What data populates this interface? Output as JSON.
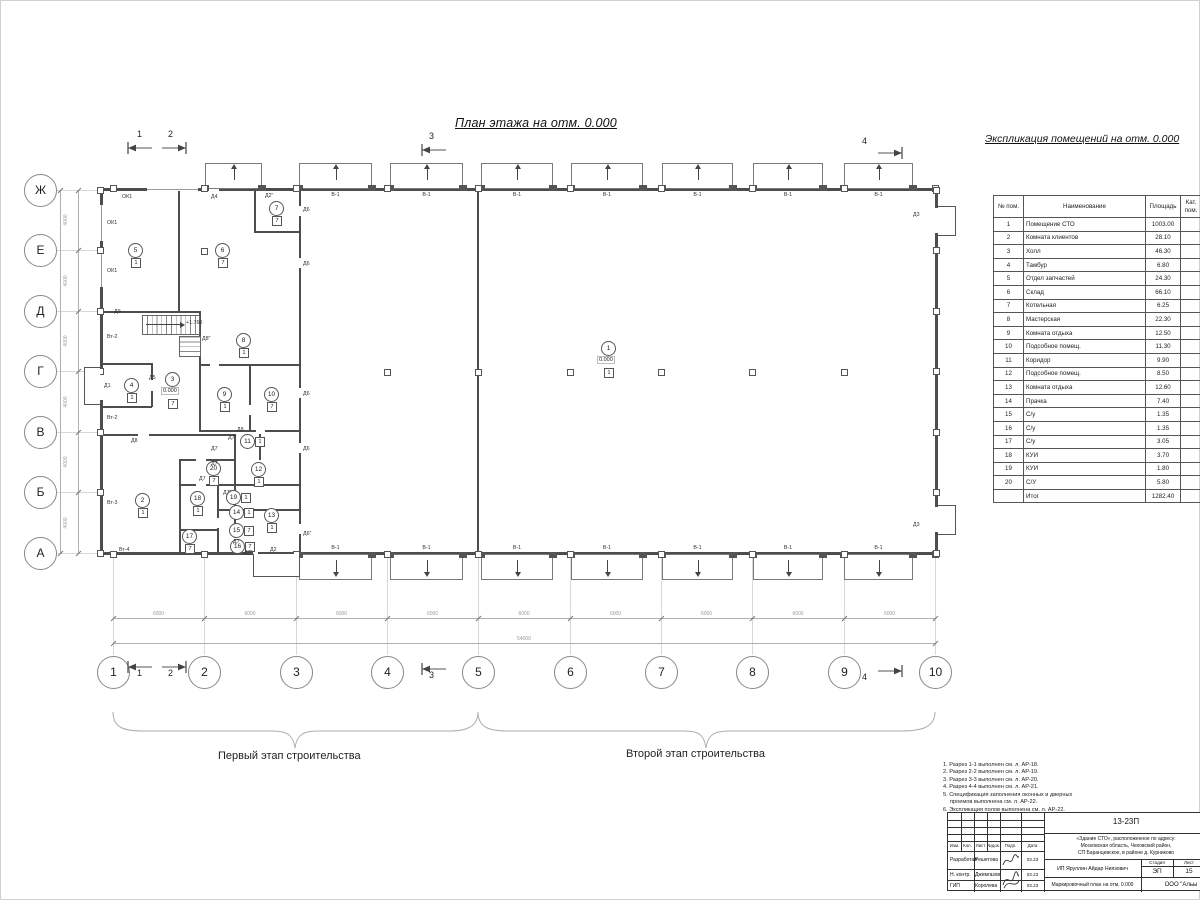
{
  "plan": {
    "title": "План этажа на отм. 0.000",
    "stage1_label": "Первый этап строительства",
    "stage2_label": "Второй этап строительства",
    "gate_label": "В-1",
    "axes_letters": [
      "Ж",
      "Е",
      "Д",
      "Г",
      "В",
      "Б",
      "А"
    ],
    "axes_numbers": [
      "1",
      "2",
      "3",
      "4",
      "5",
      "6",
      "7",
      "8",
      "9",
      "10"
    ],
    "section_markers": [
      "1",
      "2",
      "3",
      "4"
    ],
    "dims": {
      "bottom": {
        "spans": [
          "6000",
          "6000",
          "6000",
          "6000",
          "6000",
          "6000",
          "6000",
          "6000",
          "6000"
        ],
        "total": "54000"
      },
      "left": {
        "spans": [
          "4000",
          "4000",
          "4000",
          "4000",
          "4000",
          "4000"
        ],
        "total": "24000"
      }
    },
    "rooms": [
      {
        "n": "1",
        "cat": "1",
        "lvl": "0.000",
        "x": 608,
        "y": 348
      },
      {
        "n": "2",
        "cat": "1",
        "x": 142,
        "y": 500
      },
      {
        "n": "3",
        "cat": "7",
        "lvl": "0.000",
        "x": 172,
        "y": 379
      },
      {
        "n": "4",
        "cat": "1",
        "x": 131,
        "y": 385
      },
      {
        "n": "5",
        "cat": "1",
        "x": 135,
        "y": 250
      },
      {
        "n": "6",
        "cat": "7",
        "x": 222,
        "y": 250
      },
      {
        "n": "7",
        "cat": "7",
        "x": 276,
        "y": 208
      },
      {
        "n": "8",
        "cat": "1",
        "x": 243,
        "y": 340
      },
      {
        "n": "9",
        "cat": "1",
        "x": 224,
        "y": 394
      },
      {
        "n": "10",
        "cat": "7",
        "x": 271,
        "y": 394
      },
      {
        "n": "11",
        "cat": "1",
        "x": 247,
        "y": 441
      },
      {
        "n": "12",
        "cat": "1",
        "x": 258,
        "y": 469
      },
      {
        "n": "13",
        "cat": "1",
        "x": 271,
        "y": 515
      },
      {
        "n": "14",
        "cat": "1",
        "x": 236,
        "y": 512
      },
      {
        "n": "15",
        "cat": "7",
        "x": 236,
        "y": 530
      },
      {
        "n": "16",
        "cat": "7",
        "x": 237,
        "y": 546
      },
      {
        "n": "17",
        "cat": "7",
        "x": 189,
        "y": 536
      },
      {
        "n": "18",
        "cat": "1",
        "x": 197,
        "y": 498
      },
      {
        "n": "19",
        "cat": "1",
        "x": 233,
        "y": 497
      },
      {
        "n": "20",
        "cat": "7",
        "x": 213,
        "y": 468
      }
    ],
    "labels": [
      {
        "t": "ОК1",
        "x": 122,
        "y": 194
      },
      {
        "t": "ОК1",
        "x": 107,
        "y": 220
      },
      {
        "t": "ОК1",
        "x": 107,
        "y": 268
      },
      {
        "t": "Д4",
        "x": 211,
        "y": 194
      },
      {
        "t": "Д2\"",
        "x": 265,
        "y": 193
      },
      {
        "t": "Д6",
        "x": 303,
        "y": 207
      },
      {
        "t": "Д6",
        "x": 303,
        "y": 261
      },
      {
        "t": "Д6",
        "x": 303,
        "y": 391
      },
      {
        "t": "Д6",
        "x": 303,
        "y": 446
      },
      {
        "t": "Д6\"",
        "x": 303,
        "y": 531
      },
      {
        "t": "Д9",
        "x": 114,
        "y": 309
      },
      {
        "t": "Вт-2",
        "x": 107,
        "y": 334
      },
      {
        "t": "Вт-2",
        "x": 107,
        "y": 415
      },
      {
        "t": "Вт-3",
        "x": 107,
        "y": 500
      },
      {
        "t": "Вт-4",
        "x": 119,
        "y": 547
      },
      {
        "t": "Д1",
        "x": 104,
        "y": 383
      },
      {
        "t": "Д5",
        "x": 149,
        "y": 375
      },
      {
        "t": "Д8",
        "x": 131,
        "y": 438
      },
      {
        "t": "Д8",
        "x": 237,
        "y": 427
      },
      {
        "t": "Д8\"",
        "x": 202,
        "y": 336
      },
      {
        "t": "Д7\"",
        "x": 228,
        "y": 435
      },
      {
        "t": "Д7",
        "x": 211,
        "y": 446
      },
      {
        "t": "Д7",
        "x": 211,
        "y": 461
      },
      {
        "t": "Д7",
        "x": 199,
        "y": 476
      },
      {
        "t": "Д7\"",
        "x": 223,
        "y": 490
      },
      {
        "t": "Д7",
        "x": 233,
        "y": 539
      },
      {
        "t": "Д7\"",
        "x": 244,
        "y": 550
      },
      {
        "t": "Д2",
        "x": 270,
        "y": 547
      },
      {
        "t": "Д3",
        "x": 913,
        "y": 212
      },
      {
        "t": "Д3",
        "x": 913,
        "y": 522
      },
      {
        "t": "+1.760",
        "x": 186,
        "y": 320
      }
    ]
  },
  "schedule": {
    "title": "Экспликация помещений на отм. 0.000",
    "columns": [
      "№ пом.",
      "Наименование",
      "Площадь",
      "Кат. пом."
    ],
    "rows": [
      [
        "1",
        "Помещение СТО",
        "1003.00"
      ],
      [
        "2",
        "Комната клиентов",
        "28.10"
      ],
      [
        "3",
        "Холл",
        "46.30"
      ],
      [
        "4",
        "Тамбур",
        "6.80"
      ],
      [
        "5",
        "Отдел запчастей",
        "24.30"
      ],
      [
        "6",
        "Склад",
        "66.10"
      ],
      [
        "7",
        "Котельная",
        "6.25"
      ],
      [
        "8",
        "Мастерская",
        "22.30"
      ],
      [
        "9",
        "Комната отдыха",
        "12.50"
      ],
      [
        "10",
        "Подсобное помещ.",
        "11.30"
      ],
      [
        "11",
        "Коридор",
        "9.90"
      ],
      [
        "12",
        "Подсобное помещ.",
        "8.50"
      ],
      [
        "13",
        "Комната отдыха",
        "12.60"
      ],
      [
        "14",
        "Прачка",
        "7.40"
      ],
      [
        "15",
        "С/у",
        "1.35"
      ],
      [
        "16",
        "С/у",
        "1.35"
      ],
      [
        "17",
        "С/у",
        "3.05"
      ],
      [
        "18",
        "КУИ",
        "3.70"
      ],
      [
        "19",
        "КУИ",
        "1.80"
      ],
      [
        "20",
        "С/У",
        "5.80"
      ]
    ],
    "total_label": "Итог",
    "total_value": "1282.40"
  },
  "notes": [
    "1. Разрез 1-1 выполнен см. л. АР-18.",
    "2. Разрез 2-2 выполнен см. л. АР-19.",
    "3. Разрез 3-3 выполнен см. л. АР-20.",
    "4. Разрез 4-4 выполнен см. л. АР-21.",
    "5. Спецификация заполнения оконных и дверных проемов выполнена см. л. АР-22.",
    "6. Экспликация полов выполнена см. л. АР-22."
  ],
  "titleblock": {
    "project_code": "13-23П",
    "object_lines": [
      "«Здание СТО», расположенное по адресу:",
      "Московская область, Чеховский район,",
      "СП Баранцевское, в районе д. Курниково"
    ],
    "client": "ИП Яруллин Айдар Ниязович",
    "doc_title": "Маркировочный план на отм. 0.000",
    "company": "ООО \"Альы",
    "stage_label": "Стадия",
    "sheet_label": "Лист",
    "stage_value": "ЭП",
    "sheet_value": "15",
    "header_cols": [
      "Изм.",
      "Кол.",
      "Лист",
      "№док.",
      "Подп.",
      "Дата"
    ],
    "signers": [
      {
        "role": "Разработал",
        "name": "Решетова",
        "date": "03.23"
      },
      {
        "role": "Н. контр.",
        "name": "Джемгазов",
        "date": "03.23"
      },
      {
        "role": "ГИП",
        "name": "Королева",
        "date": "03.23"
      }
    ]
  }
}
